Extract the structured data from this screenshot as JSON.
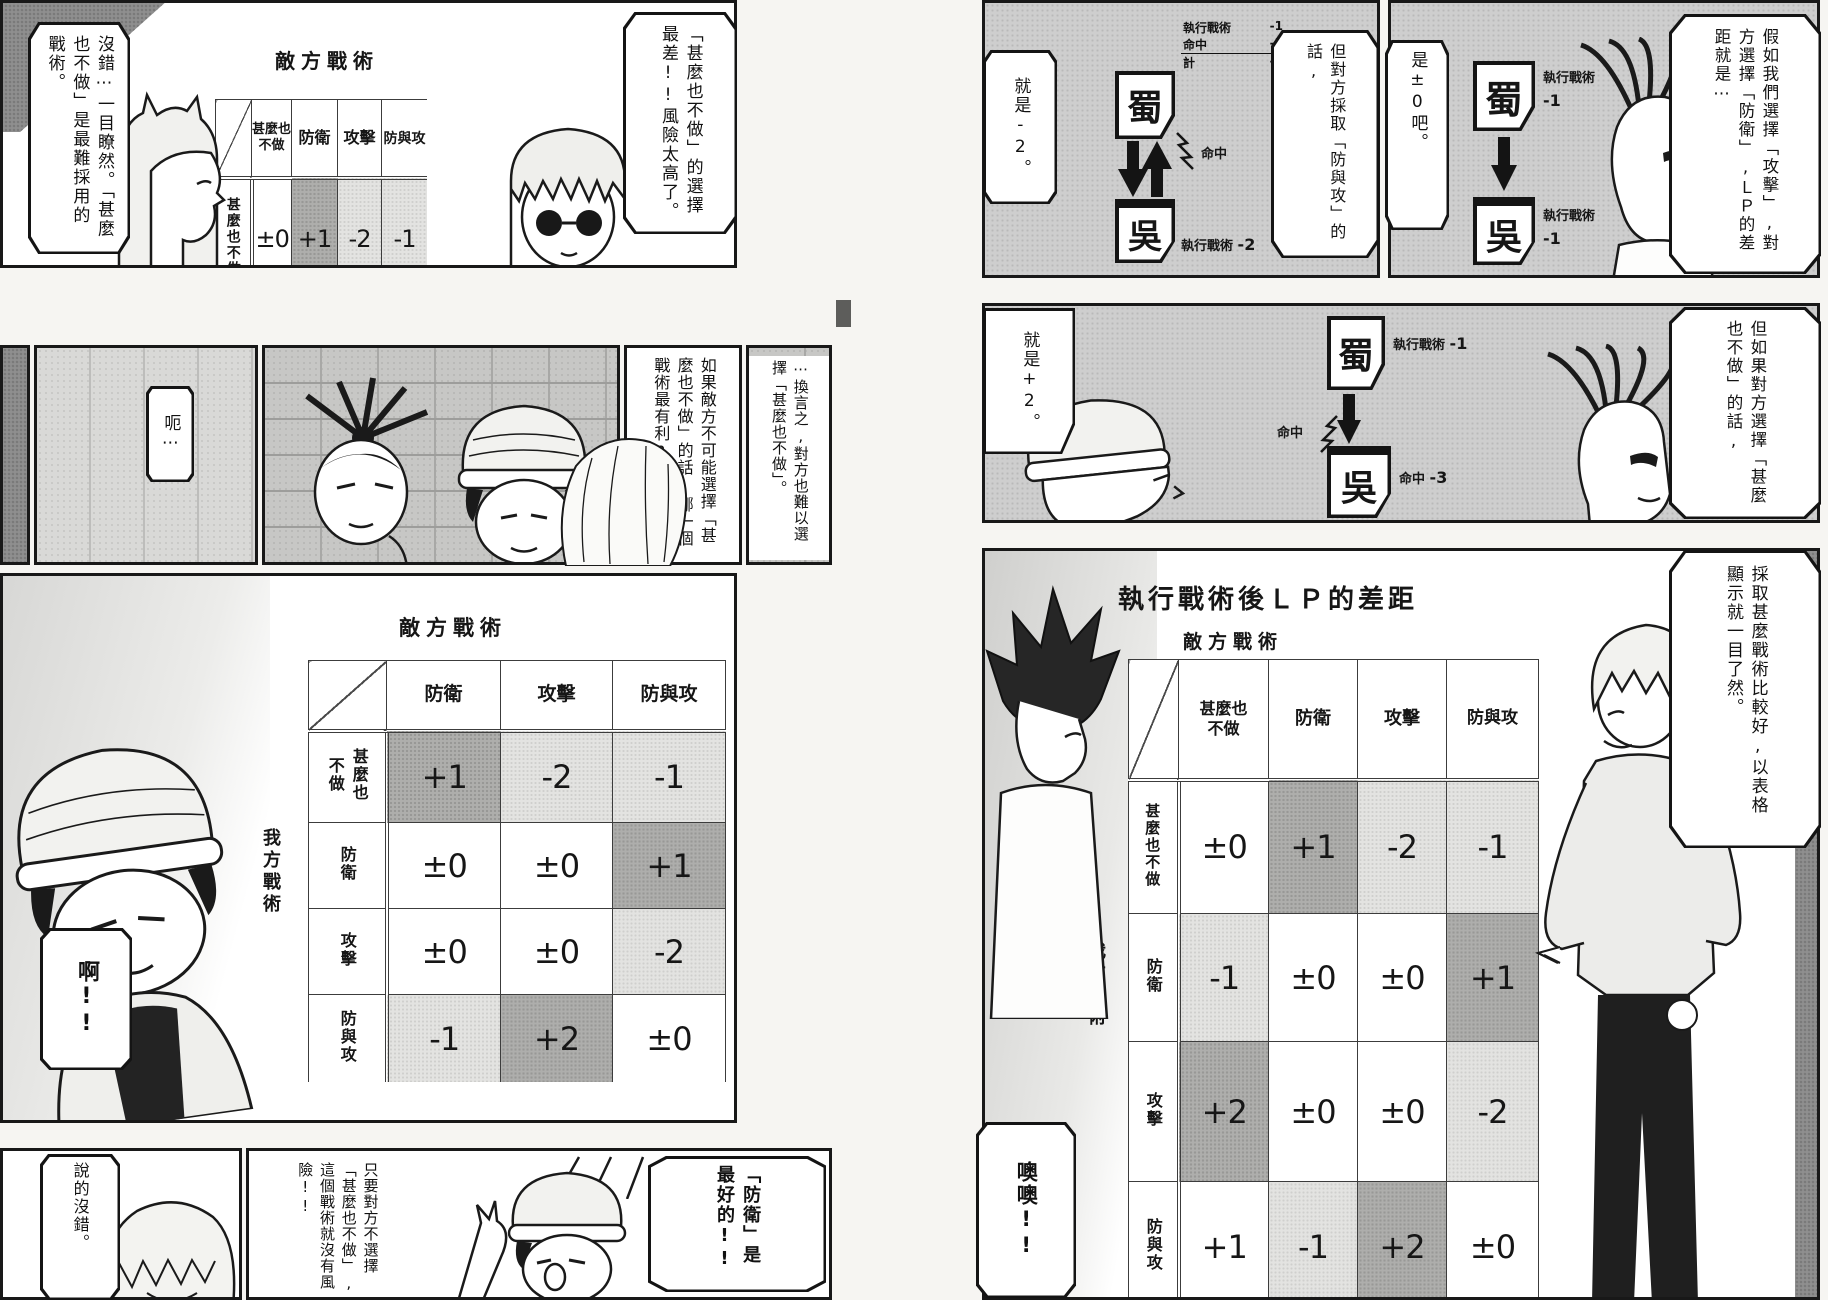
{
  "left_page": {
    "panel1": {
      "bubble_left": "沒錯⋯一目瞭然。「甚麼也不做」是最難採用的戰術。",
      "table_title": "敵方戰術",
      "side_label": "我方戰術",
      "col_headers": [
        "甚麼也不做",
        "防衛",
        "攻擊",
        "防與攻"
      ],
      "row_label": "甚麼也不做",
      "values": [
        "±0",
        "+1",
        "-2",
        "-1"
      ],
      "bubble_right": "「甚麼也不做」的選擇最差!!風險太高了。"
    },
    "panel2": {
      "bubble_left": "呃⋯",
      "bubble_mid": "如果敵方不可能選擇「甚麼也不做」的話,哪一個戰術最有利?",
      "bubble_right": "⋯換言之,對方也難以選擇「甚麼也不做」。"
    },
    "panel3": {
      "table_title": "敵方戰術",
      "side_label": "我方戰術",
      "col_headers": [
        "防衛",
        "攻擊",
        "防與攻"
      ],
      "row_headers": [
        "甚麼也不做",
        "防衛",
        "攻擊",
        "防與攻"
      ],
      "values": [
        [
          "+1",
          "-2",
          "-1"
        ],
        [
          "±0",
          "±0",
          "+1"
        ],
        [
          "±0",
          "±0",
          "-2"
        ],
        [
          "-1",
          "+2",
          "±0"
        ]
      ],
      "bubble": "啊!!"
    },
    "panel4": {
      "bubble_left": "說的沒錯。",
      "bubble_mid": "只要對方不選擇「甚麼也不做」,這個戰術就沒有風險!!",
      "bubble_right": "「防衛」是最好的!!"
    }
  },
  "right_page": {
    "strip1": {
      "panel_a": {
        "bubble_left": "就是-2。",
        "card_top": "蜀",
        "card_bottom": "吳",
        "annotation_rows": [
          {
            "label": "執行戰術",
            "value": "-1"
          },
          {
            "label": "命中",
            "value": "-3"
          },
          {
            "label": "計",
            "value": "-4"
          }
        ],
        "hit_label": "命中",
        "bottom_label": "執行戰術",
        "bottom_value": "-2",
        "bubble_right": "但對方採取「防與攻」的話,"
      },
      "panel_b": {
        "bubble_left": "是±0吧。",
        "card_top": "蜀",
        "card_top_label": "執行戰術",
        "card_top_value": "-1",
        "card_bottom": "吳",
        "card_bottom_label": "執行戰術",
        "card_bottom_value": "-1",
        "bubble_right": "假如我們選擇「攻擊」,對方選擇「防衛」,ＬＰ的差距就是⋯"
      }
    },
    "strip2": {
      "bubble_left": "就是+2。",
      "card_top": "蜀",
      "card_top_label": "執行戰術",
      "card_top_value": "-1",
      "hit_label": "命中",
      "card_bottom": "吳",
      "card_bottom_label": "命中",
      "card_bottom_value": "-3",
      "bubble_right": "但如果對方選擇「甚麼也不做」的話,"
    },
    "strip3": {
      "title": "執行戰術後ＬＰ的差距",
      "table_title": "敵方戰術",
      "side_label": "我方戰術",
      "col_headers": [
        "甚麼也不做",
        "防衛",
        "攻擊",
        "防與攻"
      ],
      "row_headers": [
        "甚麼也不做",
        "防衛",
        "攻擊",
        "防與攻"
      ],
      "values": [
        [
          "±0",
          "+1",
          "-2",
          "-1"
        ],
        [
          "-1",
          "±0",
          "±0",
          "+1"
        ],
        [
          "+2",
          "±0",
          "±0",
          "-2"
        ],
        [
          "+1",
          "-1",
          "+2",
          "±0"
        ]
      ],
      "bubble_left": "噢噢!!",
      "bubble_right": "採取甚麼戰術比較好,以表格顯示就一目了然。"
    }
  }
}
